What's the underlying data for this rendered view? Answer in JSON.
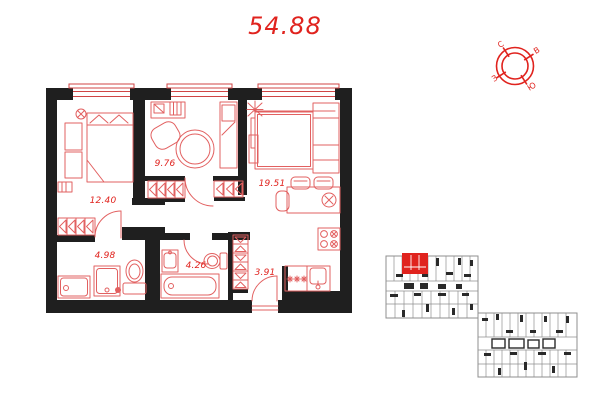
{
  "total_area": "54.88",
  "compass": {
    "north": "С",
    "east": "В",
    "south": "Ю",
    "west": "З"
  },
  "floor_plan": {
    "rooms": [
      {
        "name": "bedroom",
        "area": "12.40"
      },
      {
        "name": "room",
        "area": "9.76"
      },
      {
        "name": "living-kitchen",
        "area": "19.51"
      },
      {
        "name": "bathroom",
        "area": "4.98"
      },
      {
        "name": "bathroom-2",
        "area": "4.26"
      },
      {
        "name": "hallway",
        "area": "3.91"
      }
    ]
  },
  "colors": {
    "wall": "#1f1f1f",
    "furn": "#e26060",
    "red": "#e0231e",
    "kp-line": "#8f8f8f",
    "kp-dark": "#2a2a2a"
  }
}
